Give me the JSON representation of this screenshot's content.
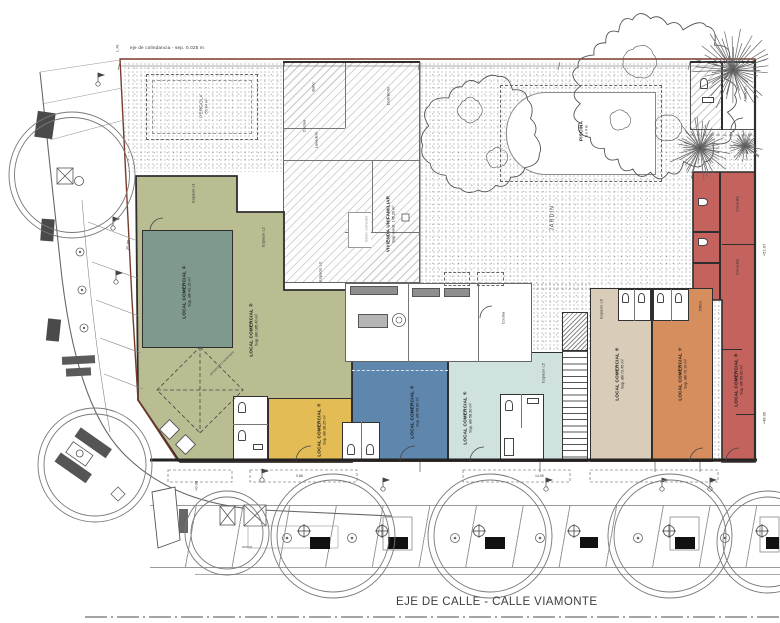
{
  "drawing": {
    "boundary_label": "eje de colindancia - sep. 0.025 m",
    "lm_label": "L.M.",
    "street_axis_label": "EJE DE CALLE - CALLE VIAMONTE",
    "sidewalk_label": "acera"
  },
  "site": {
    "garden_label": "JARDIN",
    "pool_label": "PISCINA",
    "pool_dim": "8 x 4 m",
    "pergola_label": "PÉRGOLA",
    "pergola_area": "55.04 m²",
    "skylight_label": "proyección lucernario"
  },
  "dwelling": {
    "name": "VIVIENDA UNIFAMILIAR",
    "area": "Sup. const. 145.20 m²",
    "rooms": {
      "bath": "Baño",
      "kitchen": "Cocina",
      "laundry": "Lavadero",
      "bedroom": "Dormitorio",
      "living": "Salón comedor",
      "storage": "Almacén",
      "kitchen2": "Cocina",
      "office": "Office",
      "consulta1": "Consulta",
      "consulta2": "Consulta"
    }
  },
  "locals": {
    "l1": {
      "name": "LOCAL COMERCIAL ①",
      "area": "Sup. útil 42.15 m²"
    },
    "l2": {
      "name": "LOCAL COMERCIAL ②",
      "area": "Sup. útil 185.40 m²"
    },
    "l3": {
      "name": "LOCAL COMERCIAL ③",
      "area": "Sup. útil 38.25 m²"
    },
    "l4": {
      "name": "LOCAL COMERCIAL ④",
      "area": "Sup. útil 65.80 m²"
    },
    "l5": {
      "name": "LOCAL COMERCIAL ⑤",
      "area": "Sup. útil 58.30 m²"
    },
    "l6": {
      "name": "LOCAL COMERCIAL ⑥",
      "area": "Sup. útil 72.45 m²"
    },
    "l7": {
      "name": "LOCAL COMERCIAL ⑦",
      "area": "Sup. útil 70.10 m²"
    },
    "l8": {
      "name": "LOCAL COMERCIAL ⑧",
      "area": "Sup. útil 95.60 m²"
    }
  },
  "spaces": {
    "e1": "Espacio L1",
    "e2": "Espacio L2",
    "e3": "Espacio L3",
    "e5": "Espacio L5",
    "e6": "Espacio L6"
  },
  "dims": {
    "d1": "+52.07",
    "d2": "+48.05",
    "d3": "25.89",
    "d4": "14.95",
    "d5": "9.88",
    "d6": "+0.00"
  },
  "colors": {
    "local1": "#7f9a8c",
    "local2": "#b9bd91",
    "local3": "#e3bc56",
    "local4": "#5f86ad",
    "local5": "#cfe2e0",
    "local6": "#d9cdb9",
    "local7": "#d78e5e",
    "local8": "#c4635e",
    "boundary": "#7a3a2b",
    "wall": "#2e2e2e"
  }
}
